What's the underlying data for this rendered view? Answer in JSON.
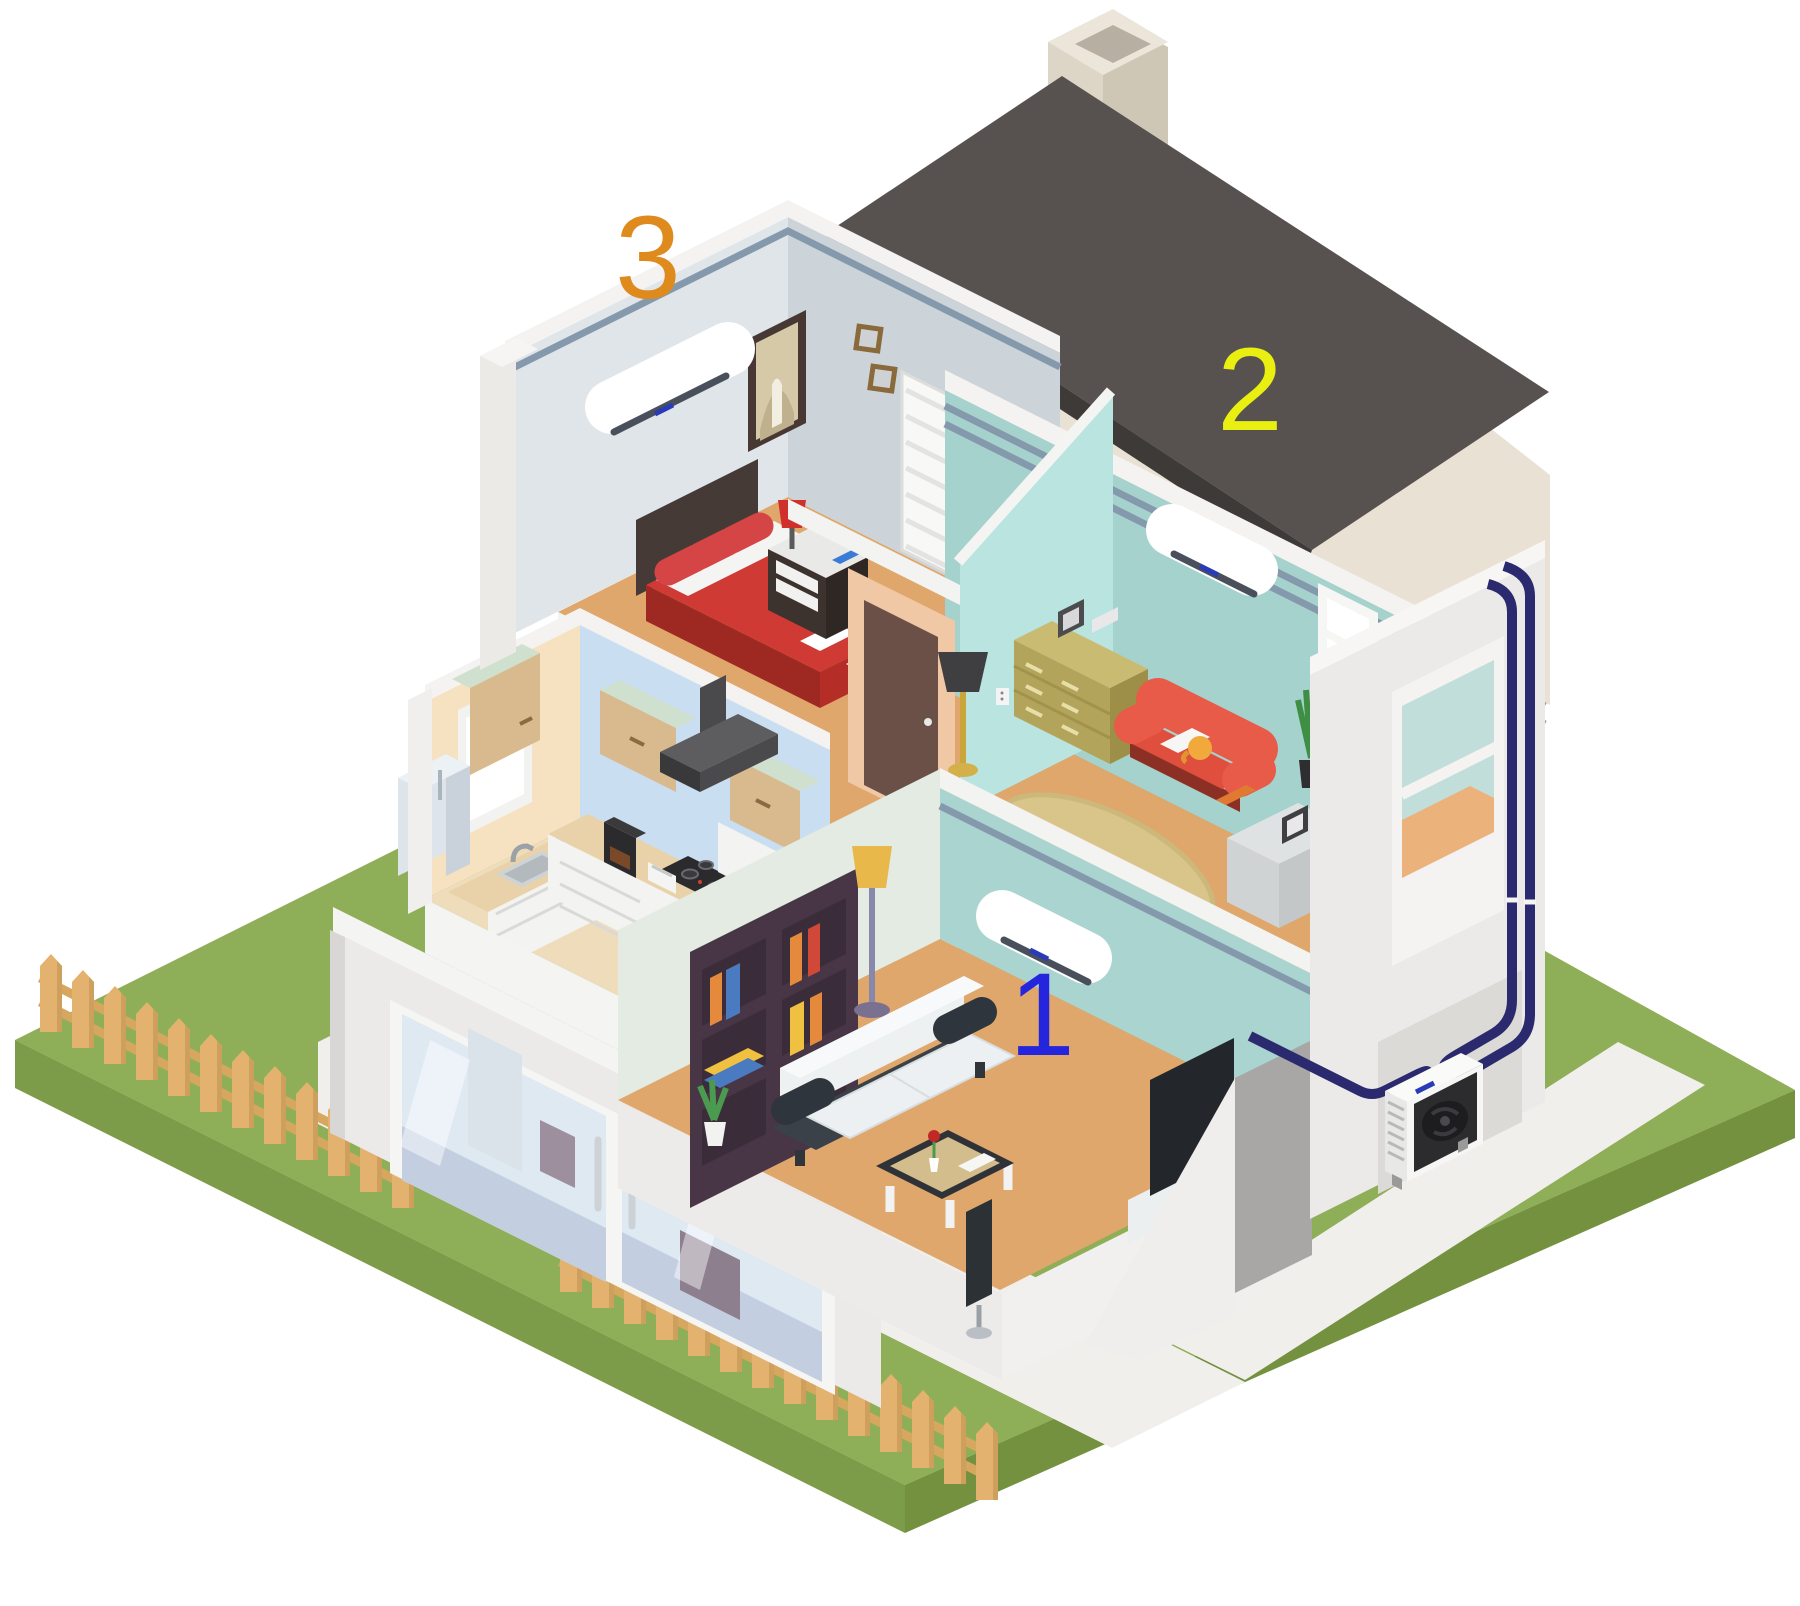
{
  "scene": {
    "kind": "isometric cutaway house with air conditioning system",
    "background": "#ffffff"
  },
  "labels": {
    "zone1": {
      "text": "1",
      "color": "#2525dd",
      "room": "ground floor living room"
    },
    "zone2": {
      "text": "2",
      "color": "#e9ef10",
      "room": "upper living room"
    },
    "zone3": {
      "text": "3",
      "color": "#df8a1d",
      "room": "bedroom"
    }
  },
  "equipment": {
    "indoor_unit_count": 3,
    "outdoor_unit_count": 1,
    "pipe_runs": 3
  },
  "rooms": [
    {
      "id": "1",
      "name": "living-room-ground",
      "has_ac_unit": true
    },
    {
      "id": "2",
      "name": "living-room-upper",
      "has_ac_unit": true
    },
    {
      "id": "3",
      "name": "bedroom",
      "has_ac_unit": true
    },
    {
      "id": "kitchen",
      "name": "kitchen",
      "has_ac_unit": false
    }
  ],
  "colors": {
    "lawn_top": "#8fae58",
    "lawn_side_left": "#7d9c4a",
    "lawn_side_right": "#73913e",
    "path": "#f0efec",
    "fence_wood": "#e3b26f",
    "fence_shade": "#cf9f5e",
    "fence_rail": "#d8a75f",
    "roof": "#575250",
    "roof_edge": "#3e3a38",
    "gable": "#e9e1d4",
    "wall_white": "#eceae8",
    "bedroom_wall": "#dfe5e8",
    "bedroom_wall_side": "#ccd4da",
    "room2_wall": "#a6d2cd",
    "hallway_wall": "#b9e4df",
    "room1_wall": "#a9d4cf",
    "room1_wall_left": "#e3ebe3",
    "kitchen_wall_left": "#f6e2c0",
    "kitchen_wall_right": "#c9def1",
    "floor_wood": "#dfa76b",
    "kitchen_floor": "#eedcba",
    "pipe": "#2c2a6e",
    "ac_body": "#ffffff",
    "ac_vent": "#4a4f5c",
    "ac_brand": "#2a3bb8",
    "trim_stripe": "#8599ac",
    "bed_red": "#cf3a34",
    "sofa_coral": "#e85b48",
    "sofa_white": "#eef1f2",
    "dresser_olive": "#b3a45c",
    "rug": "#d9c489",
    "bookshelf": "#483646"
  }
}
